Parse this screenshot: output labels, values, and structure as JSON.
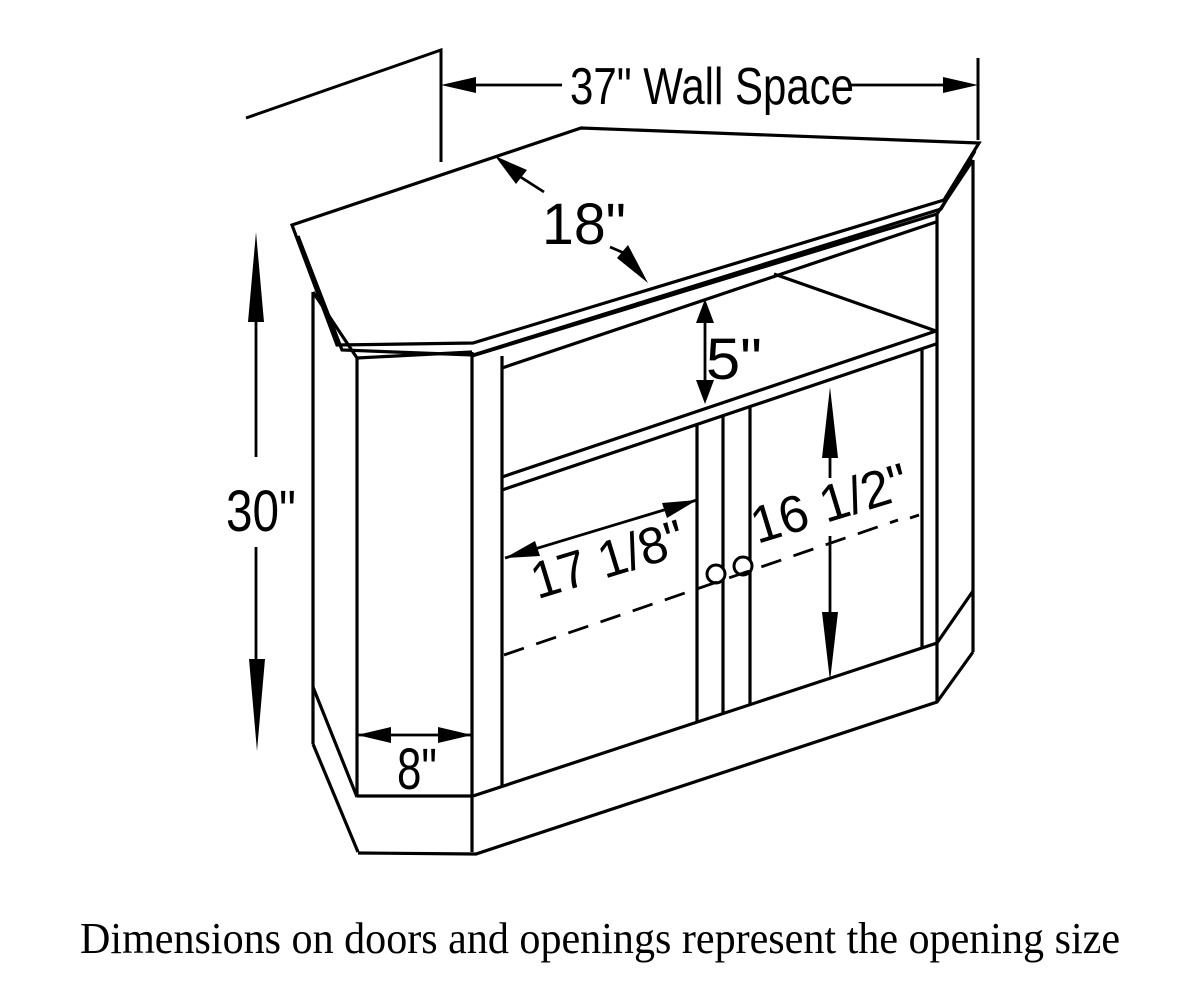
{
  "diagram": {
    "background": "#ffffff",
    "line_color": "#000000",
    "labels": {
      "wall_space": "37\" Wall Space",
      "top_depth": "18\"",
      "opening_height": "5\"",
      "overall_height": "30\"",
      "door_opening_width": "17 1/8\"",
      "door_opening_height": "16 1/2\"",
      "side_panel_width": "8\""
    },
    "caption": "Dimensions on doors and openings represent the opening size"
  }
}
